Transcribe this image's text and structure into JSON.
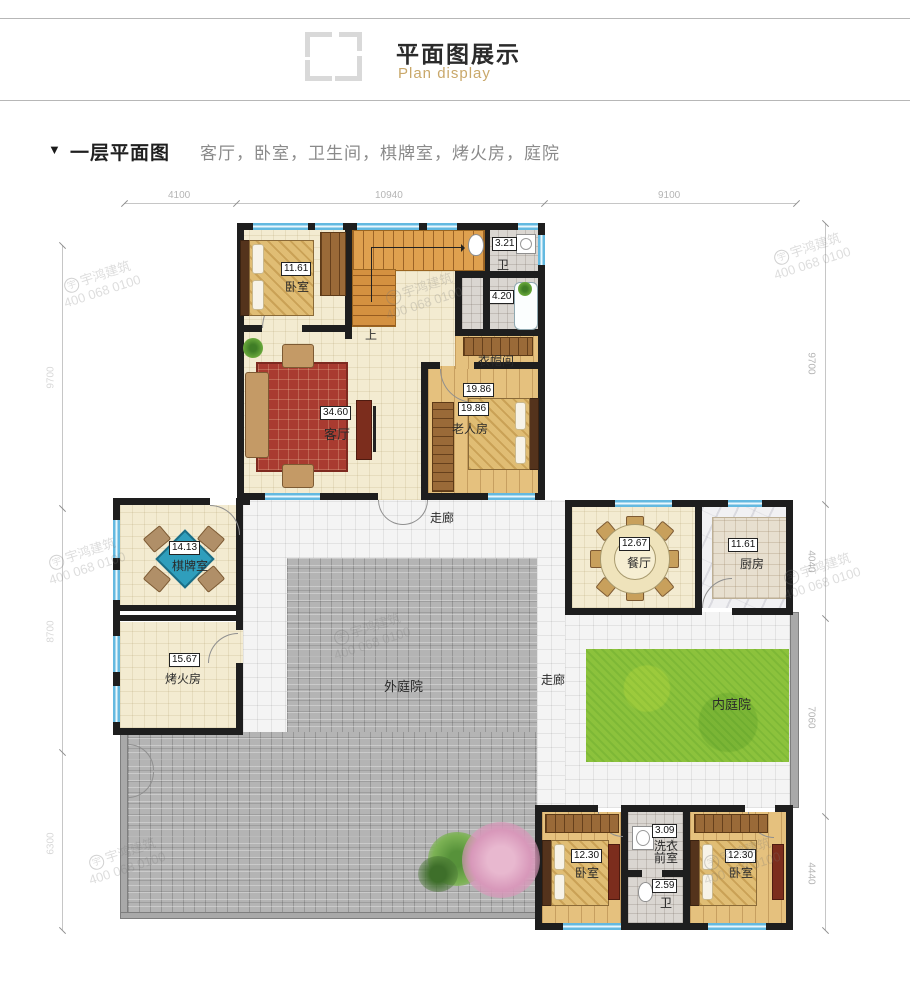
{
  "header": {
    "title": "平面图展示",
    "subtitle": "Plan display"
  },
  "section": {
    "marker": "▼",
    "title": "一层平面图",
    "rooms_list": "客厅，卧室，卫生间，棋牌室，烤火房，庭院"
  },
  "watermark": {
    "logo": "宇",
    "brand": "宇鸿建筑",
    "phone": "400 068 0100"
  },
  "dims": {
    "top": [
      "4100",
      "10940",
      "9100"
    ],
    "right": [
      "9700",
      "4040",
      "7060",
      "4440"
    ],
    "left": [
      "9700",
      "8700",
      "6300"
    ]
  },
  "labels": {
    "bedroom1": {
      "area": "11.61",
      "name": "卧室"
    },
    "bath1": {
      "area": "3.21",
      "name": "卫"
    },
    "wash": {
      "area": "4.20"
    },
    "cloak": {
      "name": "衣帽间"
    },
    "living": {
      "area": "34.60",
      "name": "客厅"
    },
    "elder": {
      "area1": "19.86",
      "area2": "19.86",
      "name": "老人房"
    },
    "corridor_top": {
      "name": "走廊"
    },
    "chess": {
      "area": "14.13",
      "name": "棋牌室"
    },
    "fire": {
      "area": "15.67",
      "name": "烤火房"
    },
    "dining": {
      "area": "12.67",
      "name": "餐厅"
    },
    "kitchen": {
      "area": "11.61",
      "name": "厨房"
    },
    "outer_yard": {
      "name": "外庭院"
    },
    "corridor_mid": {
      "name": "走廊"
    },
    "inner_yard": {
      "name": "内庭院"
    },
    "bedroom2": {
      "area": "12.30",
      "name": "卧室"
    },
    "laundry": {
      "area": "3.09",
      "line1": "洗衣",
      "line2": "前室"
    },
    "bath2": {
      "area": "2.59",
      "name": "卫"
    },
    "bedroom3": {
      "area": "12.30",
      "name": "卧室"
    },
    "stairs": {
      "up": "上"
    }
  },
  "colors": {
    "accent": "#C9A86A",
    "wall": "#1E1E1E",
    "window": "#7CC5E8",
    "grass": "#8CC23C",
    "brick": "#B5B5B5",
    "floor_cream": "#F3EBD1",
    "wood": "#E5C17E"
  }
}
